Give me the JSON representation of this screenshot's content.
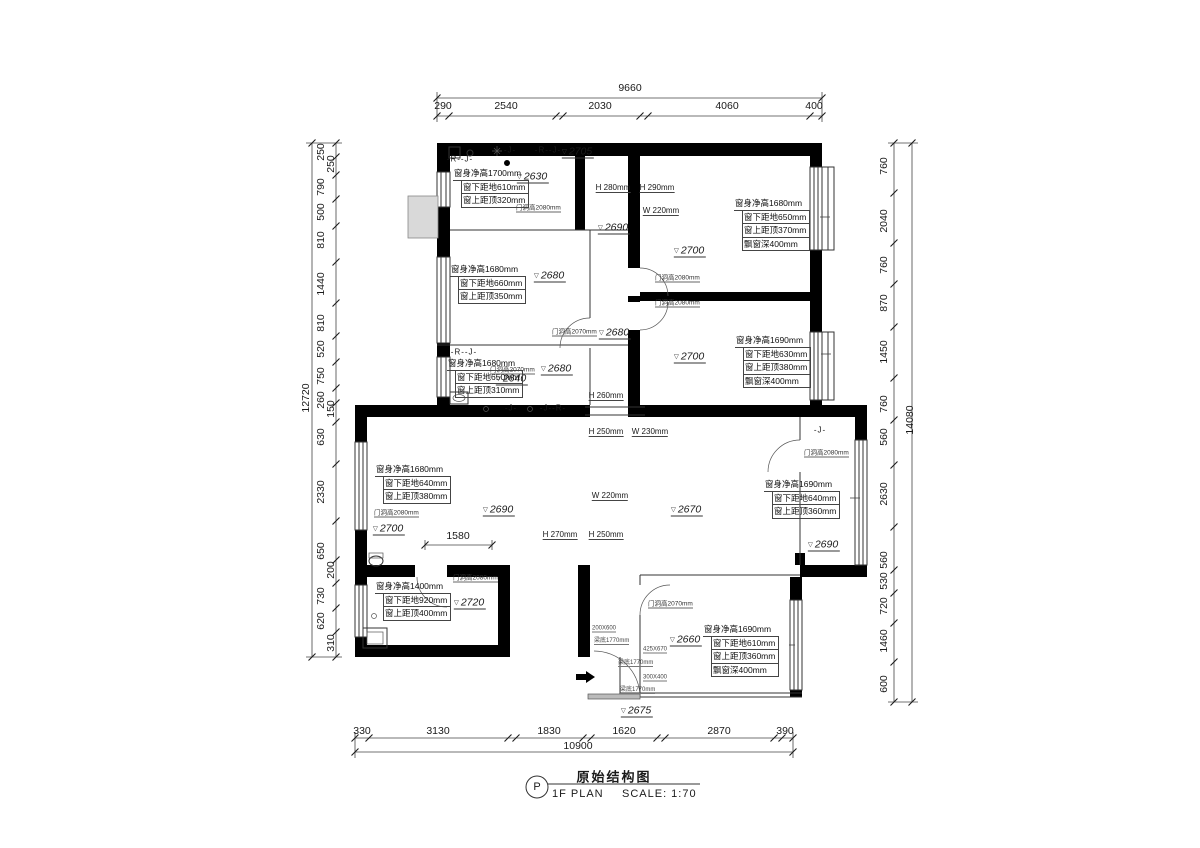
{
  "meta": {
    "drawing_title": "原始结构图",
    "plan_label": "1F PLAN",
    "scale_label": "SCALE: 1:70",
    "bubble_symbol": "P"
  },
  "dimensions": {
    "top": {
      "total": "9660",
      "segments": [
        "290",
        "2540",
        "2030",
        "4060",
        "400"
      ]
    },
    "bottom": {
      "total": "10900",
      "segments": [
        "330",
        "3130",
        "1830",
        "1620",
        "2870",
        "390"
      ]
    },
    "left": {
      "total": "12720",
      "segments": [
        "250",
        "250",
        "790",
        "500",
        "810",
        "1440",
        "810",
        "520",
        "750",
        "260",
        "150",
        "630",
        "2330",
        "650",
        "200",
        "730",
        "620",
        "310"
      ]
    },
    "right": {
      "total": "14080",
      "segments": [
        "760",
        "2040",
        "760",
        "870",
        "1450",
        "760",
        "560",
        "2630",
        "560",
        "530",
        "720",
        "1460",
        "600"
      ]
    },
    "interior": [
      "1580"
    ]
  },
  "ceiling_levels": [
    "2705",
    "2630",
    "2690",
    "2700",
    "2680",
    "2680",
    "2680",
    "2640",
    "2700",
    "2700",
    "2690",
    "2670",
    "2690",
    "2720",
    "2660",
    "2675"
  ],
  "window_annotations": [
    {
      "x": 453,
      "y": 167,
      "rows": [
        "窗身净高1700mm",
        "窗下距地610mm",
        "窗上距顶320mm"
      ]
    },
    {
      "x": 734,
      "y": 197,
      "rows": [
        "窗身净高1680mm",
        "窗下距地650mm",
        "窗上距顶370mm",
        "飘窗深400mm"
      ]
    },
    {
      "x": 735,
      "y": 334,
      "rows": [
        "窗身净高1690mm",
        "窗下距地630mm",
        "窗上距顶380mm",
        "飘窗深400mm"
      ]
    },
    {
      "x": 450,
      "y": 263,
      "rows": [
        "窗身净高1680mm",
        "窗下距地660mm",
        "窗上距顶350mm"
      ]
    },
    {
      "x": 447,
      "y": 357,
      "rows": [
        "窗身净高1680mm",
        "窗下距地650mm",
        "窗上距顶310mm"
      ]
    },
    {
      "x": 375,
      "y": 463,
      "rows": [
        "窗身净高1680mm",
        "窗下距地640mm",
        "窗上距顶380mm"
      ]
    },
    {
      "x": 764,
      "y": 478,
      "rows": [
        "窗身净高1690mm",
        "窗下距地640mm",
        "窗上距顶360mm"
      ]
    },
    {
      "x": 375,
      "y": 580,
      "rows": [
        "窗身净高1400mm",
        "窗下距地920mm",
        "窗上距顶400mm"
      ]
    },
    {
      "x": 703,
      "y": 623,
      "rows": [
        "窗身净高1690mm",
        "窗下距地610mm",
        "窗上距顶360mm",
        "飘窗深400mm"
      ]
    }
  ],
  "labels": [
    {
      "t": "9660",
      "x": 630,
      "y": 88,
      "c": "d"
    },
    {
      "t": "290",
      "x": 443,
      "y": 106,
      "c": "d"
    },
    {
      "t": "2540",
      "x": 506,
      "y": 106,
      "c": "d"
    },
    {
      "t": "2030",
      "x": 600,
      "y": 106,
      "c": "d"
    },
    {
      "t": "4060",
      "x": 727,
      "y": 106,
      "c": "d"
    },
    {
      "t": "400",
      "x": 814,
      "y": 106,
      "c": "d"
    },
    {
      "t": "10900",
      "x": 578,
      "y": 746,
      "c": "d"
    },
    {
      "t": "330",
      "x": 362,
      "y": 731,
      "c": "d"
    },
    {
      "t": "3130",
      "x": 438,
      "y": 731,
      "c": "d"
    },
    {
      "t": "1830",
      "x": 549,
      "y": 731,
      "c": "d"
    },
    {
      "t": "1620",
      "x": 624,
      "y": 731,
      "c": "d"
    },
    {
      "t": "2870",
      "x": 719,
      "y": 731,
      "c": "d"
    },
    {
      "t": "390",
      "x": 785,
      "y": 731,
      "c": "d"
    },
    {
      "t": "12720",
      "x": 306,
      "y": 398,
      "c": "dv"
    },
    {
      "t": "250",
      "x": 321,
      "y": 152,
      "c": "dv"
    },
    {
      "t": "250",
      "x": 331,
      "y": 164,
      "c": "dv"
    },
    {
      "t": "790",
      "x": 321,
      "y": 187,
      "c": "dv"
    },
    {
      "t": "500",
      "x": 321,
      "y": 212,
      "c": "dv"
    },
    {
      "t": "810",
      "x": 321,
      "y": 240,
      "c": "dv"
    },
    {
      "t": "1440",
      "x": 321,
      "y": 284,
      "c": "dv"
    },
    {
      "t": "810",
      "x": 321,
      "y": 323,
      "c": "dv"
    },
    {
      "t": "520",
      "x": 321,
      "y": 349,
      "c": "dv"
    },
    {
      "t": "750",
      "x": 321,
      "y": 376,
      "c": "dv"
    },
    {
      "t": "260",
      "x": 321,
      "y": 400,
      "c": "dv"
    },
    {
      "t": "150",
      "x": 331,
      "y": 409,
      "c": "dv"
    },
    {
      "t": "630",
      "x": 321,
      "y": 437,
      "c": "dv"
    },
    {
      "t": "2330",
      "x": 321,
      "y": 492,
      "c": "dv"
    },
    {
      "t": "650",
      "x": 321,
      "y": 551,
      "c": "dv"
    },
    {
      "t": "200",
      "x": 331,
      "y": 570,
      "c": "dv"
    },
    {
      "t": "730",
      "x": 321,
      "y": 596,
      "c": "dv"
    },
    {
      "t": "620",
      "x": 321,
      "y": 621,
      "c": "dv"
    },
    {
      "t": "310",
      "x": 331,
      "y": 643,
      "c": "dv"
    },
    {
      "t": "14080",
      "x": 910,
      "y": 420,
      "c": "dv"
    },
    {
      "t": "760",
      "x": 884,
      "y": 166,
      "c": "dv"
    },
    {
      "t": "2040",
      "x": 884,
      "y": 221,
      "c": "dv"
    },
    {
      "t": "760",
      "x": 884,
      "y": 265,
      "c": "dv"
    },
    {
      "t": "870",
      "x": 884,
      "y": 303,
      "c": "dv"
    },
    {
      "t": "1450",
      "x": 884,
      "y": 352,
      "c": "dv"
    },
    {
      "t": "760",
      "x": 884,
      "y": 404,
      "c": "dv"
    },
    {
      "t": "560",
      "x": 884,
      "y": 437,
      "c": "dv"
    },
    {
      "t": "2630",
      "x": 884,
      "y": 494,
      "c": "dv"
    },
    {
      "t": "560",
      "x": 884,
      "y": 560,
      "c": "dv"
    },
    {
      "t": "530",
      "x": 884,
      "y": 581,
      "c": "dv"
    },
    {
      "t": "720",
      "x": 884,
      "y": 606,
      "c": "dv"
    },
    {
      "t": "1460",
      "x": 884,
      "y": 641,
      "c": "dv"
    },
    {
      "t": "600",
      "x": 884,
      "y": 684,
      "c": "dv"
    },
    {
      "t": "1580",
      "x": 458,
      "y": 536,
      "c": "d"
    },
    {
      "t": "2705",
      "x": 578,
      "y": 152,
      "c": "lv"
    },
    {
      "t": "2630",
      "x": 533,
      "y": 177,
      "c": "lv"
    },
    {
      "t": "2690",
      "x": 614,
      "y": 228,
      "c": "lv"
    },
    {
      "t": "2700",
      "x": 690,
      "y": 251,
      "c": "lv"
    },
    {
      "t": "2680",
      "x": 550,
      "y": 276,
      "c": "lv"
    },
    {
      "t": "2680",
      "x": 615,
      "y": 333,
      "c": "lv"
    },
    {
      "t": "2680",
      "x": 557,
      "y": 369,
      "c": "lv"
    },
    {
      "t": "2640",
      "x": 512,
      "y": 379,
      "c": "lv"
    },
    {
      "t": "2700",
      "x": 690,
      "y": 357,
      "c": "lv"
    },
    {
      "t": "2700",
      "x": 389,
      "y": 529,
      "c": "lv"
    },
    {
      "t": "2690",
      "x": 499,
      "y": 510,
      "c": "lv"
    },
    {
      "t": "2670",
      "x": 687,
      "y": 510,
      "c": "lv"
    },
    {
      "t": "2690",
      "x": 824,
      "y": 545,
      "c": "lv"
    },
    {
      "t": "2720",
      "x": 470,
      "y": 603,
      "c": "lv"
    },
    {
      "t": "2660",
      "x": 686,
      "y": 640,
      "c": "lv"
    },
    {
      "t": "2675",
      "x": 637,
      "y": 711,
      "c": "lv"
    },
    {
      "t": "H 280mm",
      "x": 613,
      "y": 188,
      "c": "hw"
    },
    {
      "t": "H 290mm",
      "x": 657,
      "y": 188,
      "c": "hw"
    },
    {
      "t": "W 220mm",
      "x": 661,
      "y": 211,
      "c": "hw"
    },
    {
      "t": "H 260mm",
      "x": 606,
      "y": 396,
      "c": "hw"
    },
    {
      "t": "H 250mm",
      "x": 606,
      "y": 432,
      "c": "hw"
    },
    {
      "t": "W 230mm",
      "x": 650,
      "y": 432,
      "c": "hw"
    },
    {
      "t": "W 220mm",
      "x": 610,
      "y": 496,
      "c": "hw"
    },
    {
      "t": "H 270mm",
      "x": 560,
      "y": 535,
      "c": "hw"
    },
    {
      "t": "H 250mm",
      "x": 606,
      "y": 535,
      "c": "hw"
    },
    {
      "t": "门洞高2080mm",
      "x": 516,
      "y": 207,
      "c": "dr"
    },
    {
      "t": "门洞高2080mm",
      "x": 655,
      "y": 277,
      "c": "dr"
    },
    {
      "t": "门洞高2080mm",
      "x": 655,
      "y": 302,
      "c": "dr"
    },
    {
      "t": "门洞高2070mm",
      "x": 552,
      "y": 331,
      "c": "dr"
    },
    {
      "t": "门洞高2070mm",
      "x": 490,
      "y": 369,
      "c": "dr"
    },
    {
      "t": "门洞高2080mm",
      "x": 374,
      "y": 512,
      "c": "dr"
    },
    {
      "t": "门洞高2080mm",
      "x": 804,
      "y": 452,
      "c": "dr"
    },
    {
      "t": "门洞高2080mm",
      "x": 453,
      "y": 577,
      "c": "dr"
    },
    {
      "t": "门洞高2070mm",
      "x": 648,
      "y": 603,
      "c": "dr"
    },
    {
      "t": "-R--J-",
      "x": 460,
      "y": 159,
      "c": "mk"
    },
    {
      "t": "-J-",
      "x": 510,
      "y": 150,
      "c": "mk"
    },
    {
      "t": "-R--J-",
      "x": 548,
      "y": 150,
      "c": "mk"
    },
    {
      "t": "-R--J-",
      "x": 464,
      "y": 352,
      "c": "mk"
    },
    {
      "t": "-J-",
      "x": 511,
      "y": 408,
      "c": "mk"
    },
    {
      "t": "-J--R-",
      "x": 553,
      "y": 408,
      "c": "mk"
    },
    {
      "t": "-J-",
      "x": 820,
      "y": 430,
      "c": "mk"
    },
    {
      "t": "200X600",
      "x": 592,
      "y": 629,
      "c": "tn"
    },
    {
      "t": "梁底1770mm",
      "x": 594,
      "y": 640,
      "c": "tn"
    },
    {
      "t": "425X670",
      "x": 643,
      "y": 650,
      "c": "tn"
    },
    {
      "t": "梁底1770mm",
      "x": 618,
      "y": 662,
      "c": "tn"
    },
    {
      "t": "300X400",
      "x": 643,
      "y": 678,
      "c": "tn"
    },
    {
      "t": "梁底1770mm",
      "x": 620,
      "y": 689,
      "c": "tn"
    }
  ]
}
